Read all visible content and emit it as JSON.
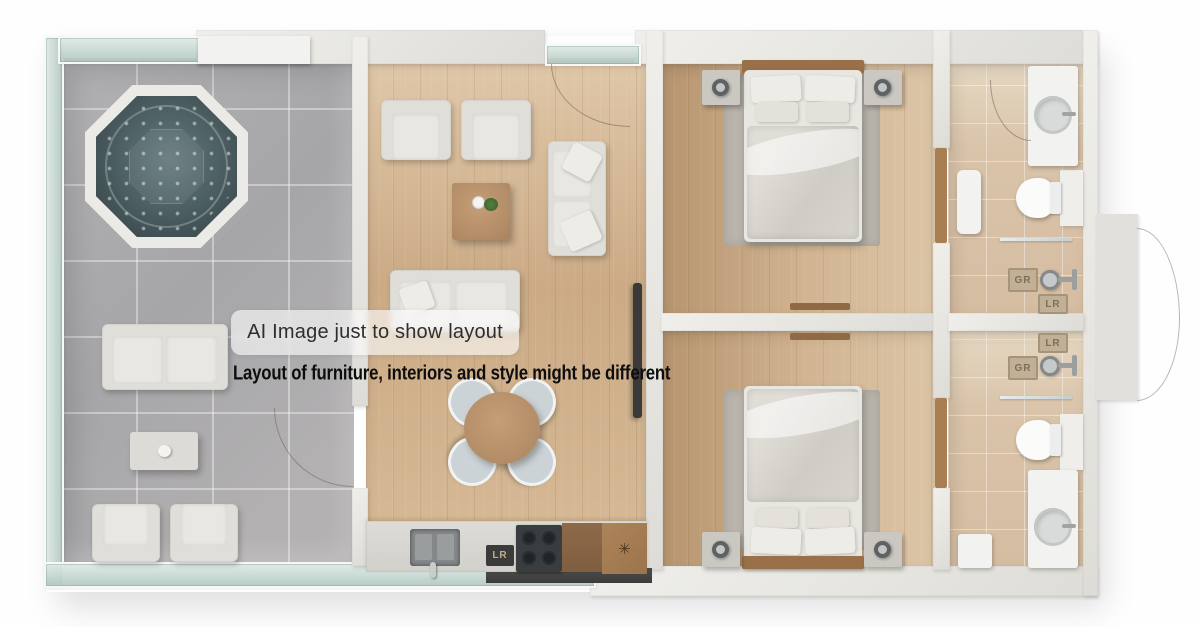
{
  "overlays": {
    "badge": "AI Image just to show layout",
    "subtitle": "Layout of furniture, interiors and style might be different"
  },
  "kitchen": {
    "appliance_label": "LR",
    "board_mark": "✳"
  },
  "bathroom_top": {
    "mats": [
      "GR",
      "LR"
    ]
  },
  "bathroom_bottom": {
    "mats": [
      "LR",
      "GR"
    ]
  },
  "colors": {
    "background": "#ffffff",
    "wall": "#e8e7e3",
    "wood_floor": "#cbaa85",
    "bedroom_floor": "#c9a881",
    "patio_tile": "#abaaac",
    "bath_tile": "#d9c3a9",
    "hot_tub_water": "#47565a",
    "glass": "#b9cec8",
    "tv": "#3a3a3a",
    "cooktop": "#3a3d40",
    "badge_text": "#2e2e2e",
    "subtitle_text": "#0d0d0d"
  }
}
